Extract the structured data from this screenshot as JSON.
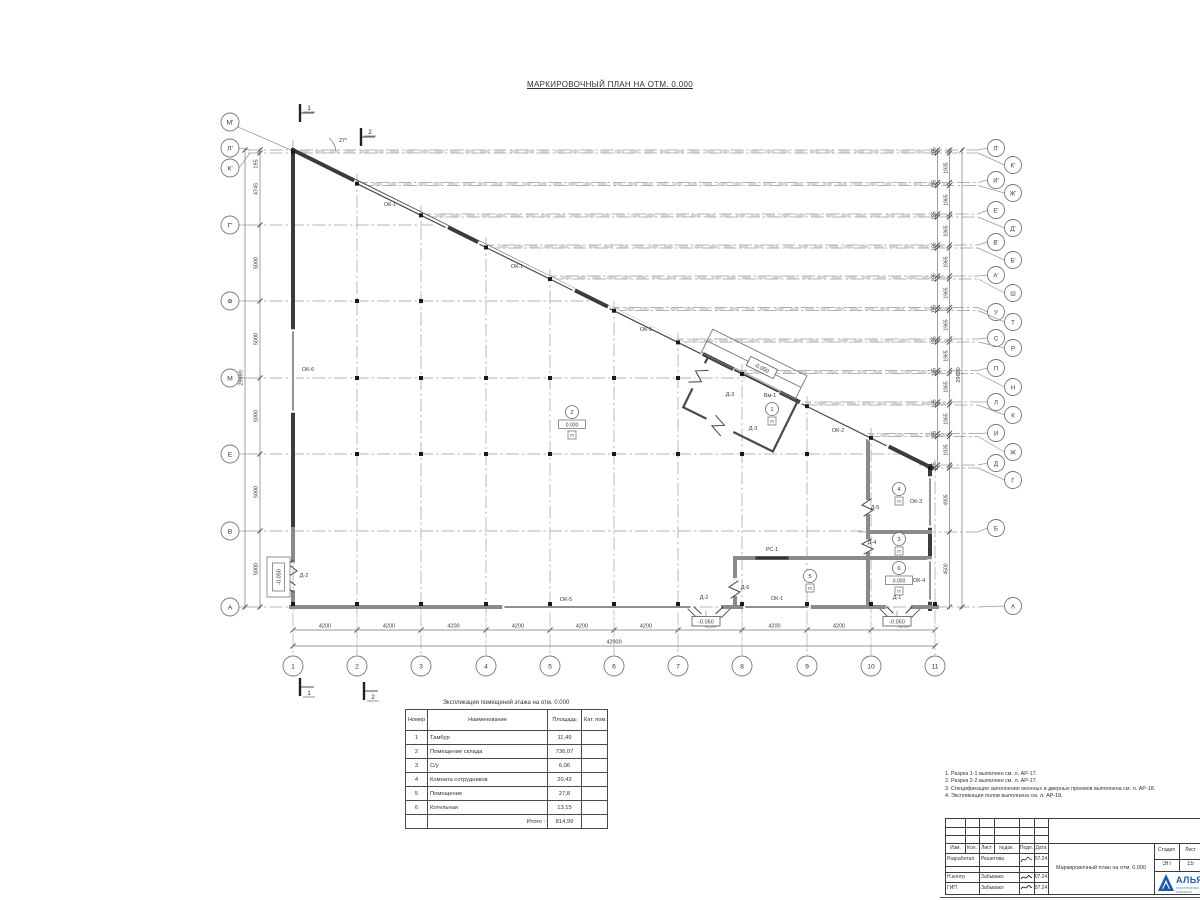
{
  "page_title": "МАРКИРОВОЧНЫЙ ПЛАН НА ОТМ. 0.000",
  "plan": {
    "angle_label": "27°",
    "tambour_level": "-0.050",
    "left_level_mark": "-0.050",
    "sections": {
      "top1": "1",
      "top2": "2",
      "bot1": "1",
      "bot2": "2"
    },
    "columns": [
      {
        "label": "1",
        "x": 293
      },
      {
        "label": "2",
        "x": 357
      },
      {
        "label": "3",
        "x": 421
      },
      {
        "label": "4",
        "x": 486
      },
      {
        "label": "5",
        "x": 550
      },
      {
        "label": "6",
        "x": 614
      },
      {
        "label": "7",
        "x": 678
      },
      {
        "label": "8",
        "x": 742
      },
      {
        "label": "9",
        "x": 807
      },
      {
        "label": "10",
        "x": 871
      },
      {
        "label": "11",
        "x": 935
      }
    ],
    "left_axes": [
      {
        "label": "М'",
        "cy": 122,
        "diag": true
      },
      {
        "label": "Л'",
        "cy": 148,
        "lineY": 150,
        "x2": 296
      },
      {
        "label": "К'",
        "cy": 168,
        "lineY": 153,
        "x2": 296
      },
      {
        "label": "Г'",
        "cy": 225,
        "lineY": 225,
        "x2": 440
      },
      {
        "label": "Ф",
        "cy": 301,
        "lineY": 301,
        "x2": 592
      },
      {
        "label": "М",
        "cy": 378,
        "lineY": 378,
        "x2": 748
      },
      {
        "label": "Е",
        "cy": 454,
        "lineY": 454,
        "x2": 900
      },
      {
        "label": "В",
        "cy": 531,
        "lineY": 531,
        "x2": 932
      },
      {
        "label": "А",
        "cy": 607,
        "lineY": 607,
        "x2": 935
      }
    ],
    "right_axes": [
      {
        "label": "Л'",
        "cy": 148,
        "lineY": 150,
        "x1": 300
      },
      {
        "label": "К'",
        "cy": 165,
        "lineY": 153,
        "x1": 300
      },
      {
        "label": "И'",
        "cy": 180,
        "lineY": 182.5,
        "x1": 355
      },
      {
        "label": "Ж'",
        "cy": 193,
        "lineY": 185.5,
        "x1": 361
      },
      {
        "label": "Е'",
        "cy": 210,
        "lineY": 214,
        "x1": 418
      },
      {
        "label": "Д'",
        "cy": 228,
        "lineY": 217,
        "x1": 424
      },
      {
        "label": "В'",
        "cy": 242,
        "lineY": 245,
        "x1": 481
      },
      {
        "label": "Б'",
        "cy": 260,
        "lineY": 248,
        "x1": 487
      },
      {
        "label": "А'",
        "cy": 275,
        "lineY": 276,
        "x1": 544
      },
      {
        "label": "Ш",
        "cy": 293,
        "lineY": 279,
        "x1": 550
      },
      {
        "label": "У",
        "cy": 312,
        "lineY": 307.5,
        "x1": 607
      },
      {
        "label": "Т",
        "cy": 322,
        "lineY": 310.5,
        "x1": 613
      },
      {
        "label": "С",
        "cy": 338,
        "lineY": 339,
        "x1": 671
      },
      {
        "label": "Р",
        "cy": 348,
        "lineY": 342,
        "x1": 677
      },
      {
        "label": "П",
        "cy": 368,
        "lineY": 370.5,
        "x1": 734
      },
      {
        "label": "Н",
        "cy": 387,
        "lineY": 373.5,
        "x1": 740
      },
      {
        "label": "Л",
        "cy": 402,
        "lineY": 402,
        "x1": 798
      },
      {
        "label": "К",
        "cy": 415,
        "lineY": 405,
        "x1": 804
      },
      {
        "label": "И",
        "cy": 433,
        "lineY": 433.5,
        "x1": 861
      },
      {
        "label": "Ж",
        "cy": 452,
        "lineY": 436.5,
        "x1": 867
      },
      {
        "label": "Д",
        "cy": 463,
        "lineY": 465,
        "x1": 919
      },
      {
        "label": "Г",
        "cy": 480,
        "lineY": 468,
        "x1": 925
      },
      {
        "label": "Б",
        "cy": 528,
        "lineY": 532,
        "x1": 858
      },
      {
        "label": "А",
        "cy": 606,
        "lineY": 607,
        "x1": 935
      }
    ],
    "bands": [
      {
        "y": 151.5,
        "x1": 300
      },
      {
        "y": 184,
        "x1": 358
      },
      {
        "y": 215.5,
        "x1": 421
      },
      {
        "y": 246.5,
        "x1": 484
      },
      {
        "y": 277.5,
        "x1": 547
      },
      {
        "y": 309,
        "x1": 610
      },
      {
        "y": 340.5,
        "x1": 674
      },
      {
        "y": 372,
        "x1": 738
      },
      {
        "y": 403.5,
        "x1": 802
      },
      {
        "y": 435,
        "x1": 865
      }
    ],
    "dims_bottom": [
      {
        "t": "4200",
        "x": 325
      },
      {
        "t": "4200",
        "x": 389
      },
      {
        "t": "4200",
        "x": 453.5
      },
      {
        "t": "4200",
        "x": 518
      },
      {
        "t": "4200",
        "x": 582
      },
      {
        "t": "4200",
        "x": 646
      },
      {
        "t": "4200",
        "x": 710
      },
      {
        "t": "4200",
        "x": 774.5
      },
      {
        "t": "4200",
        "x": 839
      },
      {
        "t": "4200",
        "x": 903
      }
    ],
    "dim_bottom_total": {
      "t": "42000",
      "x": 614,
      "y": 643.5
    },
    "dims_left": [
      {
        "t": "195",
        "y": 164
      },
      {
        "t": "4745",
        "y": 189
      },
      {
        "t": "5000",
        "y": 263
      },
      {
        "t": "5000",
        "y": 339
      },
      {
        "t": "5000",
        "y": 416
      },
      {
        "t": "5000",
        "y": 492
      },
      {
        "t": "5000",
        "y": 569
      }
    ],
    "dim_left_total": {
      "t": "29690",
      "y": 378
    },
    "dims_right_a": [
      {
        "t": "195",
        "y": 151.5
      },
      {
        "t": "195",
        "y": 184
      },
      {
        "t": "195",
        "y": 215.5
      },
      {
        "t": "195",
        "y": 246.5
      },
      {
        "t": "195",
        "y": 277.5
      },
      {
        "t": "195",
        "y": 309
      },
      {
        "t": "195",
        "y": 340.5
      },
      {
        "t": "195",
        "y": 372
      },
      {
        "t": "195",
        "y": 403.5
      },
      {
        "t": "195",
        "y": 435
      },
      {
        "t": "195",
        "y": 466.5
      }
    ],
    "dims_right_b": [
      {
        "t": "1935",
        "y": 168
      },
      {
        "t": "1965",
        "y": 200
      },
      {
        "t": "1965",
        "y": 231
      },
      {
        "t": "1965",
        "y": 262
      },
      {
        "t": "1965",
        "y": 293
      },
      {
        "t": "1965",
        "y": 325
      },
      {
        "t": "1965",
        "y": 356
      },
      {
        "t": "1965",
        "y": 387
      },
      {
        "t": "1965",
        "y": 419
      },
      {
        "t": "1935",
        "y": 450
      },
      {
        "t": "4905",
        "y": 500
      },
      {
        "t": "4500",
        "y": 569
      }
    ],
    "dim_right_total": {
      "t": "29690",
      "y": 375
    },
    "labels": [
      {
        "t": "ОК-1",
        "x": 390,
        "y": 206
      },
      {
        "t": "ОК-1",
        "x": 517,
        "y": 268
      },
      {
        "t": "ОК-1",
        "x": 646,
        "y": 331
      },
      {
        "t": "ОК-2",
        "x": 838,
        "y": 432
      },
      {
        "t": "ОК-6",
        "x": 308,
        "y": 371
      },
      {
        "t": "ОК-3",
        "x": 916,
        "y": 503
      },
      {
        "t": "ОК-4",
        "x": 919,
        "y": 582
      },
      {
        "t": "ОК-5",
        "x": 566,
        "y": 601
      },
      {
        "t": "ОК-1",
        "x": 777,
        "y": 600
      },
      {
        "t": "РС-1",
        "x": 772,
        "y": 551
      },
      {
        "t": "Вм-1",
        "x": 770,
        "y": 397
      },
      {
        "t": "Д-3",
        "x": 730,
        "y": 396
      },
      {
        "t": "Д-3",
        "x": 753,
        "y": 430
      },
      {
        "t": "Д-5",
        "x": 875,
        "y": 509
      },
      {
        "t": "Д-4",
        "x": 872,
        "y": 544
      },
      {
        "t": "Д-6",
        "x": 745,
        "y": 589
      },
      {
        "t": "Д-2",
        "x": 704,
        "y": 599
      },
      {
        "t": "Д-1",
        "x": 897,
        "y": 599
      },
      {
        "t": "Д-2",
        "x": 304,
        "y": 577
      }
    ],
    "room_tags": [
      {
        "num": "1",
        "x": 772,
        "y": 409,
        "level": "",
        "floor": "П"
      },
      {
        "num": "2",
        "x": 572,
        "y": 412,
        "level": "0.000",
        "floor": "П"
      },
      {
        "num": "3",
        "x": 899,
        "y": 539,
        "level": "",
        "floor": "П"
      },
      {
        "num": "4",
        "x": 899,
        "y": 489,
        "level": "",
        "floor": "П"
      },
      {
        "num": "5",
        "x": 810,
        "y": 576,
        "level": "",
        "floor": "П"
      },
      {
        "num": "6",
        "x": 899,
        "y": 568,
        "level": "0.000",
        "floor": "П"
      }
    ],
    "level_marks": [
      {
        "t": "-0.050",
        "x": 706,
        "y": 622
      },
      {
        "t": "-0.050",
        "x": 897,
        "y": 622
      }
    ]
  },
  "table": {
    "caption": "Экспликация помещений этажа на отм. 0.000",
    "headers": {
      "num": "Номер помещ.",
      "name": "Наименование",
      "area": "Площадь",
      "cat": "Кат. пом."
    },
    "rows": [
      {
        "num": "1",
        "name": "Тамбур",
        "area": "11,49",
        "cat": ""
      },
      {
        "num": "2",
        "name": "Помещение склада",
        "area": "736,07",
        "cat": ""
      },
      {
        "num": "3",
        "name": "С/у",
        "area": "6,06",
        "cat": ""
      },
      {
        "num": "4",
        "name": "Комната сотрудников",
        "area": "20,42",
        "cat": ""
      },
      {
        "num": "5",
        "name": "Помещение",
        "area": "27,8",
        "cat": ""
      },
      {
        "num": "6",
        "name": "Котельная",
        "area": "13,15",
        "cat": ""
      }
    ],
    "total_label": "Итого :",
    "total_value": "814,99"
  },
  "notes": [
    "1. Разрез 1-1 выполнен см. л. АР-17.",
    "2. Разрез 2-2 выполнен см. л. АР-17.",
    "3. Спецификация заполнения оконных и дверных проемов выполнена см. л. АР-18.",
    "4. Экспликация полов выполнена см. л. АР-18."
  ],
  "titleblock": {
    "header": {
      "izm": "Изм.",
      "kol": "Кол.",
      "list": "Лист",
      "ndok": "№док.",
      "podp": "Подп.",
      "data": "Дата"
    },
    "rows": [
      {
        "role": "Разработал",
        "name": "Решетова",
        "date": "07.24"
      },
      {
        "role": "",
        "name": "",
        "date": ""
      },
      {
        "role": "Н.контр",
        "name": "Забывако",
        "date": "07.24"
      },
      {
        "role": "ГИП",
        "name": "Забывако",
        "date": "07.24"
      }
    ],
    "doc_title": "Маркировочный план на отм. 0.000",
    "stage_label": "Стадия",
    "stage_value": "ЭП",
    "sheet_label": "Лист",
    "sheet_value": "15",
    "logo_text": "АЛЬЯНС",
    "logo_sub": "строительная компания",
    "logo_color": "#1d5aa8"
  }
}
